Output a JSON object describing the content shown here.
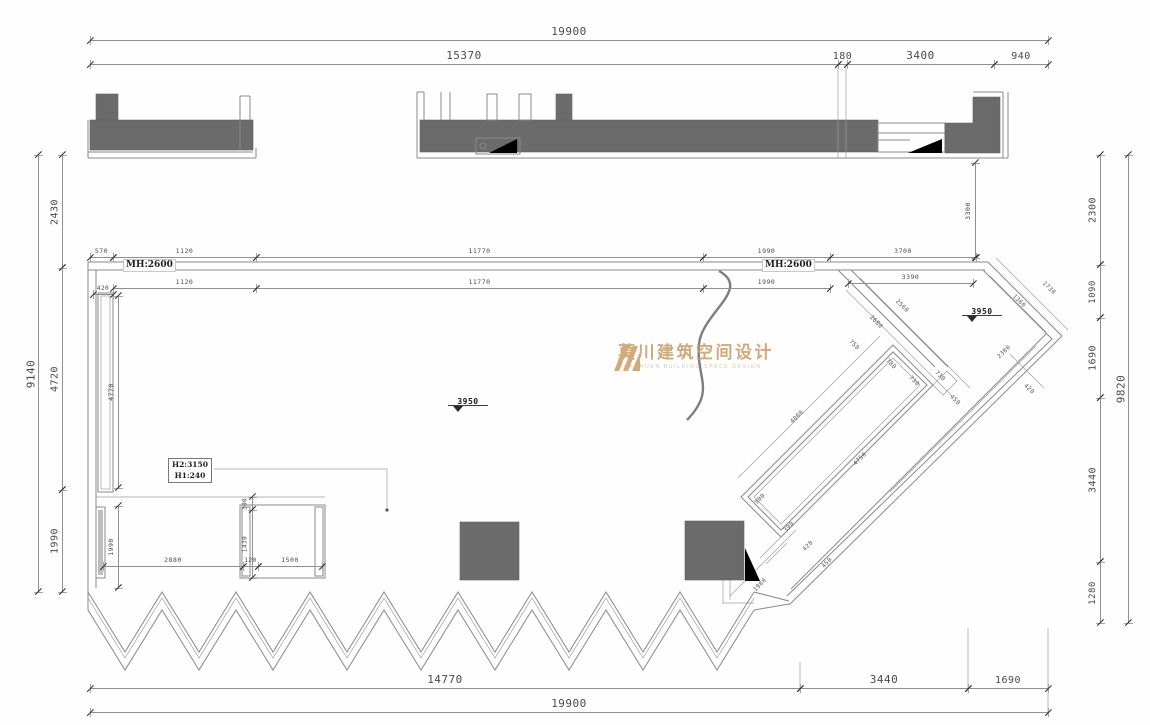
{
  "drawing_type": "floor-plan",
  "colors": {
    "wall_fill": "#6b6b6b",
    "line_gray": "#8a8a8a",
    "dim_text": "#4a4a4a",
    "logo_gold": "#c9a36b"
  },
  "watermark": {
    "cn": "莫川建筑空间设计",
    "en": "MOKCHUEN BUILDING SPACE DESIGN"
  },
  "labels": {
    "mh_left": "MH:2600",
    "mh_right": "MH:2600",
    "h2": "H2:3150",
    "h1": "H1:240"
  },
  "levels": [
    {
      "t": "3950",
      "x": 448,
      "y": 397
    },
    {
      "t": "3950",
      "x": 962,
      "y": 307
    }
  ],
  "dims": [
    {
      "t": "19900",
      "o": "h",
      "x": 90,
      "y": 40,
      "len": 958,
      "fs": 11
    },
    {
      "t": "15370",
      "o": "h",
      "x": 90,
      "y": 64,
      "len": 748,
      "fs": 11
    },
    {
      "t": "180",
      "o": "h",
      "x": 838,
      "y": 64,
      "len": 9,
      "fs": 10
    },
    {
      "t": "3400",
      "o": "h",
      "x": 847,
      "y": 64,
      "len": 147,
      "fs": 11
    },
    {
      "t": "940",
      "o": "h",
      "x": 994,
      "y": 64,
      "len": 54,
      "fs": 10
    },
    {
      "t": "9140",
      "o": "v",
      "x": 38,
      "y": 155,
      "len": 437,
      "fs": 11
    },
    {
      "t": "2430",
      "o": "v",
      "x": 62,
      "y": 155,
      "len": 113,
      "fs": 10
    },
    {
      "t": "4720",
      "o": "v",
      "x": 62,
      "y": 268,
      "len": 222,
      "fs": 10
    },
    {
      "t": "1990",
      "o": "v",
      "x": 62,
      "y": 490,
      "len": 102,
      "fs": 10
    },
    {
      "t": "2300",
      "o": "v",
      "x": 1100,
      "y": 155,
      "len": 110,
      "fs": 10
    },
    {
      "t": "1090",
      "o": "v",
      "x": 1100,
      "y": 265,
      "len": 53,
      "fs": 9
    },
    {
      "t": "1690",
      "o": "v",
      "x": 1100,
      "y": 318,
      "len": 80,
      "fs": 10
    },
    {
      "t": "3440",
      "o": "v",
      "x": 1100,
      "y": 398,
      "len": 164,
      "fs": 10
    },
    {
      "t": "1280",
      "o": "v",
      "x": 1100,
      "y": 562,
      "len": 61,
      "fs": 9
    },
    {
      "t": "9820",
      "o": "v",
      "x": 1128,
      "y": 155,
      "len": 468,
      "fs": 11
    },
    {
      "t": "14770",
      "o": "h",
      "x": 90,
      "y": 688,
      "len": 710,
      "fs": 11
    },
    {
      "t": "3440",
      "o": "h",
      "x": 800,
      "y": 688,
      "len": 168,
      "fs": 11
    },
    {
      "t": "1690",
      "o": "h",
      "x": 968,
      "y": 688,
      "len": 80,
      "fs": 10
    },
    {
      "t": "19900",
      "o": "h",
      "x": 90,
      "y": 712,
      "len": 958,
      "fs": 11
    },
    {
      "t": "570",
      "o": "h",
      "x": 90,
      "y": 257,
      "len": 23,
      "fs": 6.5
    },
    {
      "t": "1120",
      "o": "h",
      "x": 113,
      "y": 257,
      "len": 143,
      "fs": 6.5
    },
    {
      "t": "11770",
      "o": "h",
      "x": 256,
      "y": 257,
      "len": 447,
      "fs": 6.5
    },
    {
      "t": "1990",
      "o": "h",
      "x": 703,
      "y": 257,
      "len": 127,
      "fs": 6.5
    },
    {
      "t": "3700",
      "o": "h",
      "x": 830,
      "y": 257,
      "len": 146,
      "fs": 6.5
    },
    {
      "t": "420",
      "o": "h",
      "x": 93,
      "y": 294,
      "len": 20,
      "fs": 6
    },
    {
      "t": "1120",
      "o": "h",
      "x": 113,
      "y": 288,
      "len": 143,
      "fs": 6.5
    },
    {
      "t": "11770",
      "o": "h",
      "x": 256,
      "y": 288,
      "len": 447,
      "fs": 6.5
    },
    {
      "t": "1990",
      "o": "h",
      "x": 703,
      "y": 288,
      "len": 127,
      "fs": 6.5
    },
    {
      "t": "3390",
      "o": "h",
      "x": 848,
      "y": 283,
      "len": 125,
      "fs": 6.5
    },
    {
      "t": "4770",
      "o": "v",
      "x": 118,
      "y": 296,
      "len": 192,
      "fs": 6.5
    },
    {
      "t": "1990",
      "o": "v",
      "x": 118,
      "y": 506,
      "len": 82,
      "fs": 6.5
    },
    {
      "t": "2880",
      "o": "h",
      "x": 103,
      "y": 566,
      "len": 140,
      "fs": 6.5
    },
    {
      "t": "300",
      "o": "v",
      "x": 252,
      "y": 497,
      "len": 13,
      "fs": 6
    },
    {
      "t": "1430",
      "o": "v",
      "x": 252,
      "y": 510,
      "len": 68,
      "fs": 6
    },
    {
      "t": "120",
      "o": "h",
      "x": 243,
      "y": 566,
      "len": 15,
      "fs": 6
    },
    {
      "t": "1500",
      "o": "h",
      "x": 258,
      "y": 566,
      "len": 64,
      "fs": 6.5
    },
    {
      "t": "3300",
      "o": "v",
      "x": 975,
      "y": 163,
      "len": 95,
      "fs": 6.5
    }
  ],
  "diag_dims": [
    {
      "t": "2560",
      "x": 902,
      "y": 306,
      "r": 45
    },
    {
      "t": "2680",
      "x": 876,
      "y": 322,
      "r": 45
    },
    {
      "t": "750",
      "x": 854,
      "y": 345,
      "r": 45
    },
    {
      "t": "780",
      "x": 891,
      "y": 364,
      "r": 45
    },
    {
      "t": "730",
      "x": 914,
      "y": 381,
      "r": 45
    },
    {
      "t": "730",
      "x": 940,
      "y": 376,
      "r": 45
    },
    {
      "t": "450",
      "x": 955,
      "y": 400,
      "r": 45
    },
    {
      "t": "420",
      "x": 1029,
      "y": 389,
      "r": 45
    },
    {
      "t": "1360",
      "x": 1019,
      "y": 301,
      "r": 45
    },
    {
      "t": "1730",
      "x": 1049,
      "y": 288,
      "r": 45
    },
    {
      "t": "2380",
      "x": 1004,
      "y": 352,
      "r": -45
    },
    {
      "t": "4000",
      "x": 797,
      "y": 417,
      "r": -45
    },
    {
      "t": "4750",
      "x": 860,
      "y": 459,
      "r": -45
    },
    {
      "t": "900",
      "x": 760,
      "y": 499,
      "r": -45
    },
    {
      "t": "390",
      "x": 789,
      "y": 527,
      "r": -45
    },
    {
      "t": "420",
      "x": 808,
      "y": 546,
      "r": -45
    },
    {
      "t": "450",
      "x": 827,
      "y": 563,
      "r": -45
    },
    {
      "t": "1980",
      "x": 760,
      "y": 585,
      "r": -45
    }
  ]
}
